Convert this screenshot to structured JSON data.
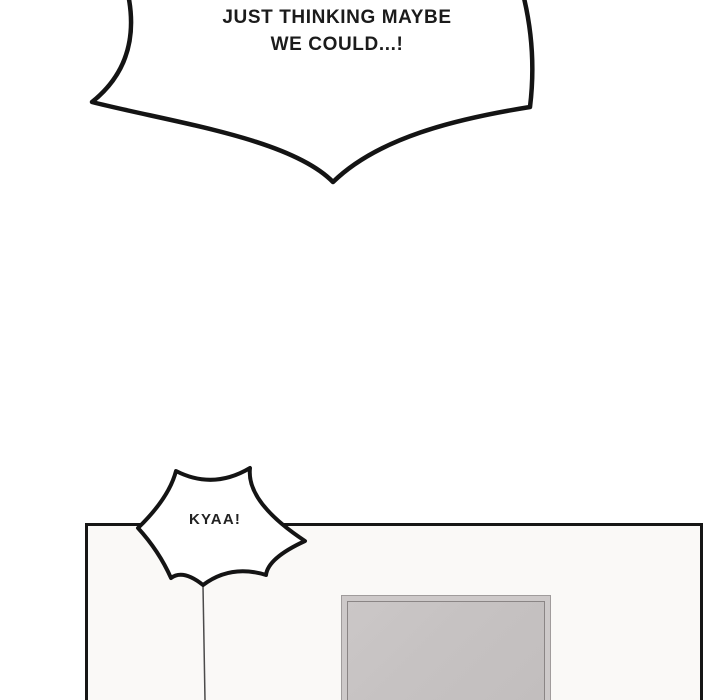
{
  "comic": {
    "speech_bubble": {
      "line1": "JUST THINKING MAYBE",
      "line2": "WE COULD...!"
    },
    "burst_bubble": {
      "text": "KYAA!"
    },
    "colors": {
      "ink": "#141414",
      "page_background": "#ffffff",
      "panel_background": "#faf9f7",
      "frame_band": "#cdc9c9",
      "frame_fill": "#c6c2c2",
      "frame_line": "#8a8585",
      "tail_line": "#4b4b4b"
    }
  }
}
